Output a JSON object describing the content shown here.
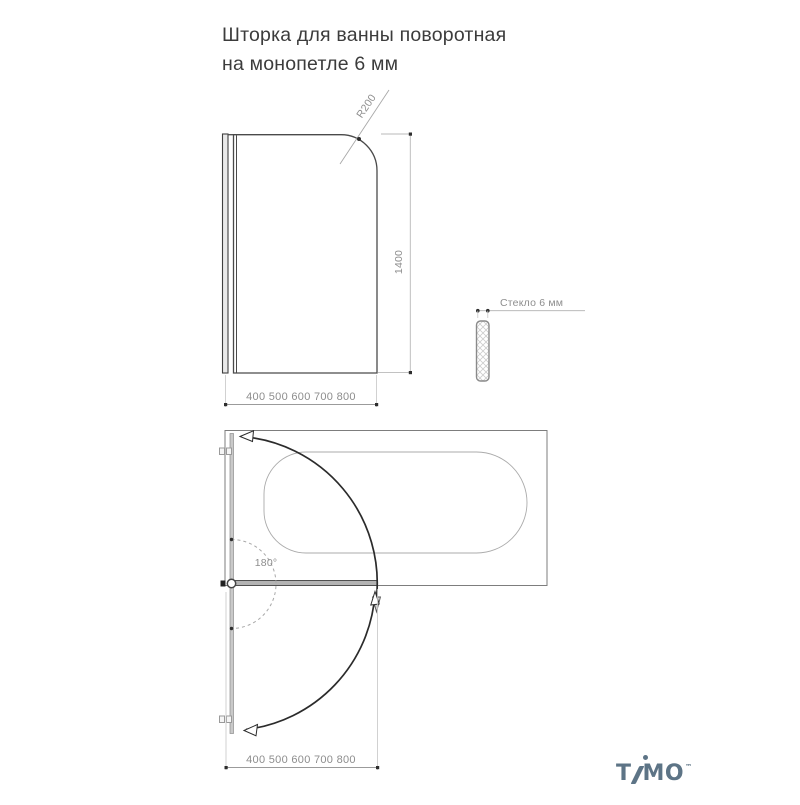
{
  "title": {
    "line1": "Шторка для ванны поворотная",
    "line2": "на монопетле 6 мм"
  },
  "front_view": {
    "corner_radius_label": "R200",
    "height_label": "1400",
    "width_options_label": "400 500 600 700 800"
  },
  "side_view": {
    "glass_thickness_label": "Стекло 6 мм"
  },
  "top_view": {
    "swing_angle_label": "180°",
    "width_options_label": "400 500 600 700 800"
  },
  "logo": {
    "brand": "TIMO",
    "part1": "T",
    "part2": "MO",
    "trademark": "™"
  },
  "colors": {
    "background": "#ffffff",
    "title_text": "#3c3c3c",
    "drawing_stroke": "#454545",
    "dimension_stroke": "#9b9b9b",
    "dimension_text": "#8d8d8d",
    "glass_fill": "#b3b3b3",
    "logo": "#5d7486"
  }
}
